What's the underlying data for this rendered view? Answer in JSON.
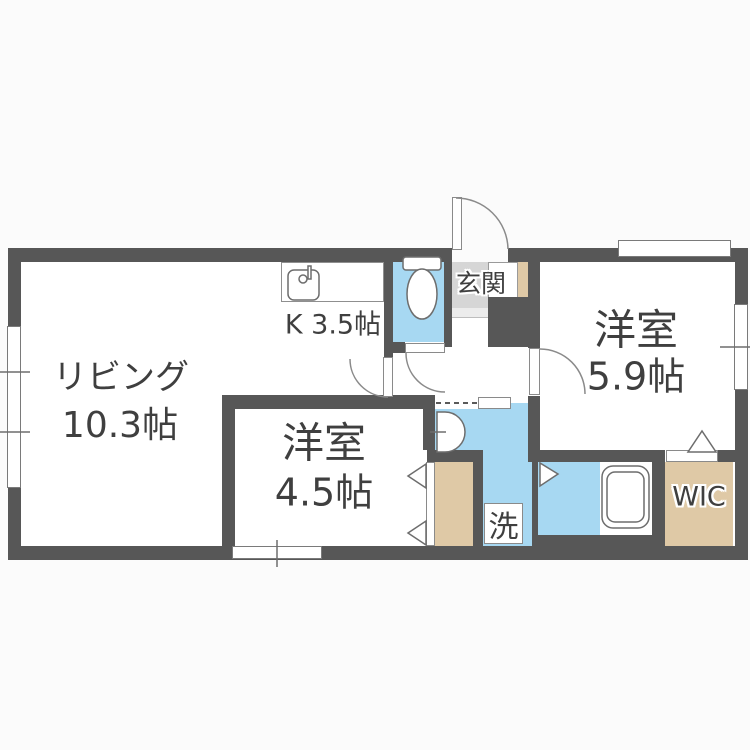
{
  "document": {
    "type": "apartment-floor-plan",
    "style": "japanese-madori"
  },
  "rooms": {
    "living": {
      "name": "リビング",
      "size": "10.3帖"
    },
    "kitchen": {
      "label": "K 3.5帖"
    },
    "bedroom_right": {
      "name": "洋室",
      "size": "5.9帖"
    },
    "bedroom_left": {
      "name": "洋室",
      "size": "4.5帖"
    },
    "entrance": {
      "label": "玄関"
    },
    "laundry": {
      "label": "洗"
    },
    "wic": {
      "label": "WIC"
    },
    "toilet": {
      "label": ""
    },
    "bath": {
      "label": ""
    }
  },
  "icons": [
    "kitchen-sink-icon",
    "toilet-icon",
    "washbasin-icon",
    "bathtub-icon",
    "door-swing-arc",
    "folding-door-triangle",
    "window-glyph"
  ],
  "colors": {
    "wall": "#575757",
    "water_area_floor": "#a7d8f2",
    "closet_floor": "#dfc9a6",
    "entrance_tile": "#d6d6d6",
    "room_floor": "#ffffff",
    "label_text": "#3f3f3f",
    "background": "#fbfbfb"
  }
}
